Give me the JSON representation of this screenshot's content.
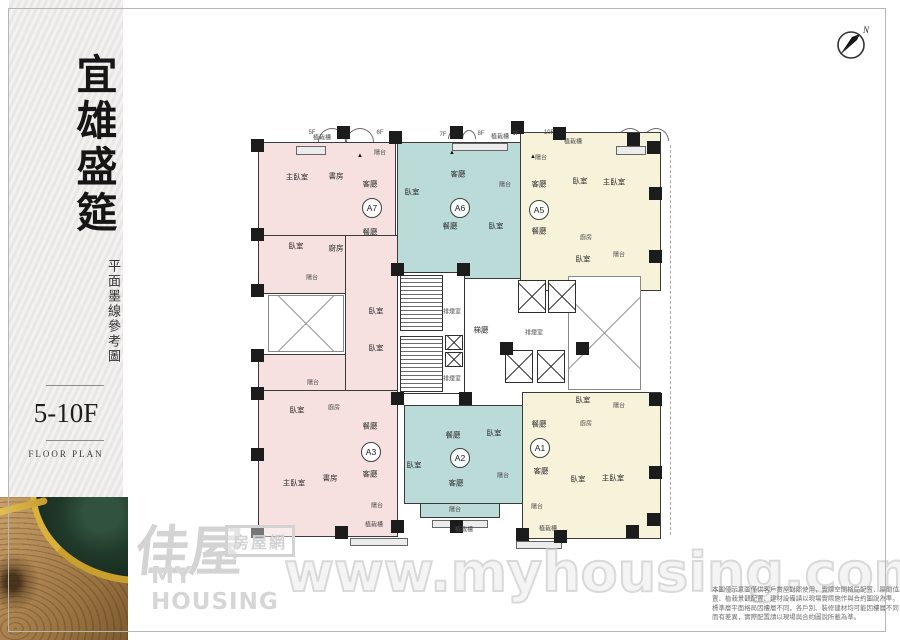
{
  "sidebar": {
    "title": "宜雄盛筵",
    "subtitle": "平面墨線參考圖",
    "floor_range": "5-10F",
    "floor_plan_label": "FLOOR PLAN"
  },
  "compass": {
    "label": "N"
  },
  "watermark": {
    "logo_zh": "佳屋",
    "logo_box": "房屋網",
    "logo_en": "MY HOUSING",
    "url_text": "www.myhousing.com.tw"
  },
  "disclaimer": {
    "lines": [
      "本圖僅示意圖僅供客戶賞屋對照使用，實際空間格局配置、隔間位",
      "置、植栽景觀配置、建材設備請以現場實際施作與合約圖說為準。",
      "標準層平面格局因樓層不同，各戶別、裝修建材均可能因樓層不同",
      "而有差異，實際配置請以現場與合約圖說所載為準。"
    ]
  },
  "plan": {
    "colors": {
      "pink": "#f6e0e0",
      "teal": "#bbdbd8",
      "cream": "#f7f3da",
      "wall": "#3a3a3a"
    },
    "regions": [
      {
        "x": 258,
        "y": 142,
        "w": 138,
        "h": 94,
        "c": "pink"
      },
      {
        "x": 258,
        "y": 235,
        "w": 88,
        "h": 59,
        "c": "pink"
      },
      {
        "x": 345,
        "y": 235,
        "w": 53,
        "h": 158,
        "c": "pink"
      },
      {
        "x": 258,
        "y": 354,
        "w": 88,
        "h": 37,
        "c": "pink"
      },
      {
        "x": 258,
        "y": 390,
        "w": 140,
        "h": 147,
        "c": "pink"
      },
      {
        "x": 397,
        "y": 142,
        "w": 128,
        "h": 137,
        "c": "teal"
      },
      {
        "x": 404,
        "y": 405,
        "w": 119,
        "h": 99,
        "c": "teal"
      },
      {
        "x": 420,
        "y": 503,
        "w": 80,
        "h": 15,
        "c": "teal"
      },
      {
        "x": 520,
        "y": 132,
        "w": 141,
        "h": 159,
        "c": "cream"
      },
      {
        "x": 522,
        "y": 392,
        "w": 139,
        "h": 147,
        "c": "cream"
      }
    ],
    "core": [
      {
        "x": 397,
        "y": 272,
        "w": 68,
        "h": 122
      }
    ],
    "stairs": [
      {
        "x": 400,
        "y": 275,
        "w": 43,
        "h": 56
      },
      {
        "x": 400,
        "y": 336,
        "w": 43,
        "h": 56
      }
    ],
    "shafts": [
      {
        "x": 445,
        "y": 335,
        "w": 18,
        "h": 15
      },
      {
        "x": 445,
        "y": 352,
        "w": 18,
        "h": 15
      }
    ],
    "elevators": [
      {
        "x": 518,
        "y": 280,
        "w": 28,
        "h": 33
      },
      {
        "x": 548,
        "y": 280,
        "w": 28,
        "h": 33
      },
      {
        "x": 505,
        "y": 350,
        "w": 28,
        "h": 33
      },
      {
        "x": 537,
        "y": 350,
        "w": 28,
        "h": 33
      }
    ],
    "voids": [
      {
        "x": 268,
        "y": 295,
        "w": 76,
        "h": 57
      },
      {
        "x": 568,
        "y": 276,
        "w": 73,
        "h": 114
      }
    ],
    "arcs": [
      {
        "x": 318,
        "y": 128,
        "w": 28,
        "h": 14
      },
      {
        "x": 346,
        "y": 128,
        "w": 28,
        "h": 14
      },
      {
        "x": 448,
        "y": 130,
        "w": 14,
        "h": 9
      },
      {
        "x": 462,
        "y": 130,
        "w": 14,
        "h": 9
      },
      {
        "x": 523,
        "y": 132,
        "w": 14,
        "h": 9
      },
      {
        "x": 537,
        "y": 132,
        "w": 14,
        "h": 9
      },
      {
        "x": 617,
        "y": 128,
        "w": 26,
        "h": 13
      },
      {
        "x": 643,
        "y": 128,
        "w": 26,
        "h": 13
      }
    ],
    "planters": [
      {
        "x": 296,
        "y": 146,
        "w": 30,
        "h": 9
      },
      {
        "x": 452,
        "y": 143,
        "w": 56,
        "h": 8
      },
      {
        "x": 616,
        "y": 146,
        "w": 30,
        "h": 9
      },
      {
        "x": 350,
        "y": 538,
        "w": 58,
        "h": 8
      },
      {
        "x": 432,
        "y": 520,
        "w": 56,
        "h": 8
      },
      {
        "x": 516,
        "y": 541,
        "w": 46,
        "h": 8
      }
    ],
    "columns": [
      {
        "x": 251,
        "y": 139
      },
      {
        "x": 337,
        "y": 126
      },
      {
        "x": 389,
        "y": 131
      },
      {
        "x": 450,
        "y": 126
      },
      {
        "x": 511,
        "y": 121
      },
      {
        "x": 553,
        "y": 127
      },
      {
        "x": 627,
        "y": 133
      },
      {
        "x": 647,
        "y": 141
      },
      {
        "x": 251,
        "y": 228
      },
      {
        "x": 251,
        "y": 284
      },
      {
        "x": 251,
        "y": 349
      },
      {
        "x": 251,
        "y": 387
      },
      {
        "x": 251,
        "y": 448
      },
      {
        "x": 251,
        "y": 525
      },
      {
        "x": 335,
        "y": 526
      },
      {
        "x": 391,
        "y": 520
      },
      {
        "x": 450,
        "y": 520
      },
      {
        "x": 516,
        "y": 528
      },
      {
        "x": 554,
        "y": 530
      },
      {
        "x": 626,
        "y": 525
      },
      {
        "x": 647,
        "y": 513
      },
      {
        "x": 649,
        "y": 187
      },
      {
        "x": 649,
        "y": 250
      },
      {
        "x": 649,
        "y": 393
      },
      {
        "x": 649,
        "y": 466
      },
      {
        "x": 391,
        "y": 263
      },
      {
        "x": 457,
        "y": 263
      },
      {
        "x": 391,
        "y": 392
      },
      {
        "x": 459,
        "y": 392
      },
      {
        "x": 500,
        "y": 342
      },
      {
        "x": 576,
        "y": 342
      }
    ],
    "vents": [
      {
        "x": 360,
        "y": 156
      },
      {
        "x": 452,
        "y": 153
      },
      {
        "x": 533,
        "y": 157
      }
    ],
    "badges": [
      {
        "t": "A7",
        "x": 372,
        "y": 208
      },
      {
        "t": "A6",
        "x": 460,
        "y": 208
      },
      {
        "t": "A5",
        "x": 539,
        "y": 210
      },
      {
        "t": "A3",
        "x": 371,
        "y": 452
      },
      {
        "t": "A2",
        "x": 460,
        "y": 458
      },
      {
        "t": "A1",
        "x": 540,
        "y": 448
      }
    ],
    "labels": [
      {
        "t": "主臥室",
        "x": 297,
        "y": 177
      },
      {
        "t": "書房",
        "x": 336,
        "y": 176
      },
      {
        "t": "客廳",
        "x": 370,
        "y": 184
      },
      {
        "t": "餐廳",
        "x": 370,
        "y": 232
      },
      {
        "t": "臥室",
        "x": 296,
        "y": 246
      },
      {
        "t": "廚房",
        "x": 336,
        "y": 248
      },
      {
        "t": "陽台",
        "x": 380,
        "y": 152,
        "s": 1
      },
      {
        "t": "陽台",
        "x": 312,
        "y": 277,
        "s": 1
      },
      {
        "t": "臥室",
        "x": 376,
        "y": 311
      },
      {
        "t": "陽台",
        "x": 313,
        "y": 382,
        "s": 1
      },
      {
        "t": "臥室",
        "x": 376,
        "y": 348
      },
      {
        "t": "臥室",
        "x": 297,
        "y": 410
      },
      {
        "t": "廚房",
        "x": 334,
        "y": 407,
        "s": 1
      },
      {
        "t": "餐廳",
        "x": 370,
        "y": 426
      },
      {
        "t": "客廳",
        "x": 370,
        "y": 474
      },
      {
        "t": "書房",
        "x": 330,
        "y": 478
      },
      {
        "t": "主臥室",
        "x": 294,
        "y": 483
      },
      {
        "t": "陽台",
        "x": 377,
        "y": 505,
        "s": 1
      },
      {
        "t": "植栽槽",
        "x": 374,
        "y": 524,
        "s": 1
      },
      {
        "t": "臥室",
        "x": 412,
        "y": 192
      },
      {
        "t": "客廳",
        "x": 458,
        "y": 174
      },
      {
        "t": "陽台",
        "x": 505,
        "y": 184,
        "s": 1
      },
      {
        "t": "餐廳",
        "x": 450,
        "y": 226
      },
      {
        "t": "臥室",
        "x": 496,
        "y": 226
      },
      {
        "t": "餐廳",
        "x": 453,
        "y": 435
      },
      {
        "t": "臥室",
        "x": 494,
        "y": 433
      },
      {
        "t": "臥室",
        "x": 414,
        "y": 465
      },
      {
        "t": "客廳",
        "x": 456,
        "y": 483
      },
      {
        "t": "陽台",
        "x": 503,
        "y": 475,
        "s": 1
      },
      {
        "t": "陽台",
        "x": 455,
        "y": 509,
        "s": 1
      },
      {
        "t": "植栽槽",
        "x": 464,
        "y": 529,
        "s": 1
      },
      {
        "t": "陽台",
        "x": 541,
        "y": 157,
        "s": 1
      },
      {
        "t": "客廳",
        "x": 539,
        "y": 184
      },
      {
        "t": "臥室",
        "x": 580,
        "y": 181
      },
      {
        "t": "主臥室",
        "x": 614,
        "y": 182
      },
      {
        "t": "餐廳",
        "x": 539,
        "y": 231
      },
      {
        "t": "廚房",
        "x": 586,
        "y": 237,
        "s": 1
      },
      {
        "t": "臥室",
        "x": 583,
        "y": 259
      },
      {
        "t": "陽台",
        "x": 619,
        "y": 254,
        "s": 1
      },
      {
        "t": "臥室",
        "x": 583,
        "y": 400
      },
      {
        "t": "陽台",
        "x": 619,
        "y": 405,
        "s": 1
      },
      {
        "t": "餐廳",
        "x": 539,
        "y": 424
      },
      {
        "t": "廚房",
        "x": 586,
        "y": 423,
        "s": 1
      },
      {
        "t": "客廳",
        "x": 541,
        "y": 471
      },
      {
        "t": "臥室",
        "x": 578,
        "y": 479
      },
      {
        "t": "主臥室",
        "x": 613,
        "y": 478
      },
      {
        "t": "陽台",
        "x": 537,
        "y": 506,
        "s": 1
      },
      {
        "t": "植栽槽",
        "x": 548,
        "y": 528,
        "s": 1
      },
      {
        "t": "排煙室",
        "x": 452,
        "y": 311,
        "s": 1
      },
      {
        "t": "梯廳",
        "x": 481,
        "y": 330
      },
      {
        "t": "排煙室",
        "x": 534,
        "y": 332,
        "s": 1
      },
      {
        "t": "排煙室",
        "x": 452,
        "y": 378,
        "s": 1
      },
      {
        "t": "植栽槽",
        "x": 322,
        "y": 137,
        "s": 1
      },
      {
        "t": "植栽槽",
        "x": 500,
        "y": 136,
        "s": 1
      },
      {
        "t": "植栽槽",
        "x": 573,
        "y": 141,
        "s": 1
      },
      {
        "t": "5F",
        "x": 312,
        "y": 133,
        "s": 1
      },
      {
        "t": "6F",
        "x": 380,
        "y": 133,
        "s": 1
      },
      {
        "t": "7F",
        "x": 443,
        "y": 135,
        "s": 1
      },
      {
        "t": "8F",
        "x": 481,
        "y": 134,
        "s": 1
      },
      {
        "t": "9F",
        "x": 516,
        "y": 134,
        "s": 1
      },
      {
        "t": "10F",
        "x": 549,
        "y": 133,
        "s": 1
      }
    ]
  }
}
